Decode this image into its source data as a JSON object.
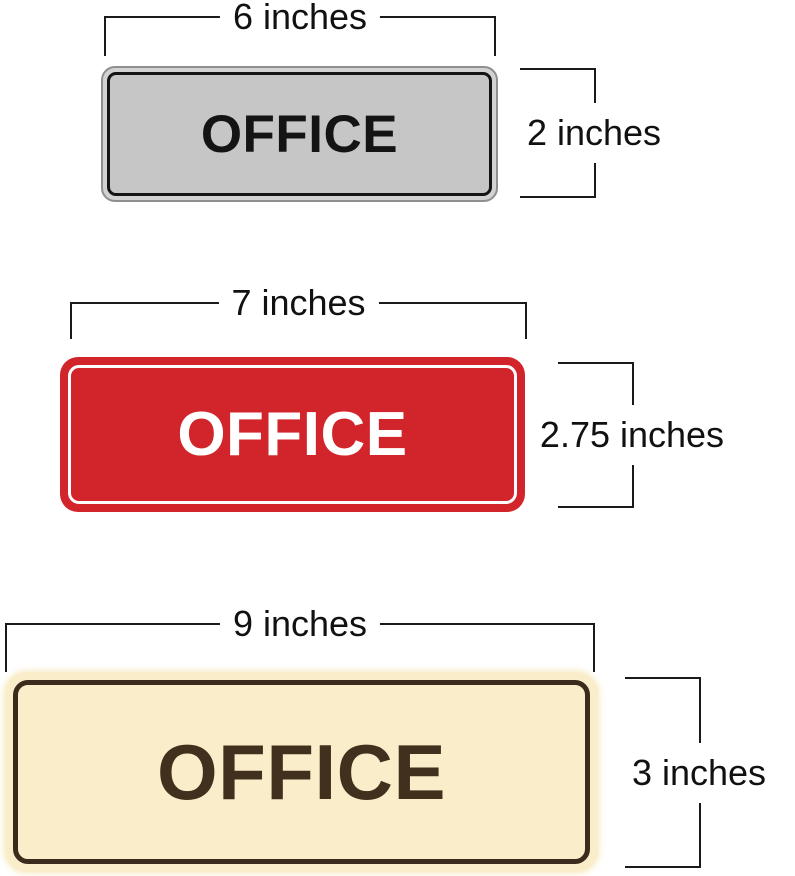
{
  "page": {
    "background": "#ffffff",
    "dimension_line_color": "#1a1a1a",
    "dimension_text_color": "#111111"
  },
  "signs": [
    {
      "name": "gray-office-sign",
      "label": "OFFICE",
      "width_label": "6 inches",
      "height_label": "2 inches",
      "colors": {
        "body": "#d2d2d2",
        "face": "#c6c6c6",
        "border": "#141414",
        "text": "#141414",
        "edge": "#8f8f8f"
      }
    },
    {
      "name": "red-office-sign",
      "label": "OFFICE",
      "width_label": "7 inches",
      "height_label": "2.75 inches",
      "colors": {
        "body": "#d2252b",
        "face": "#d2252b",
        "border": "#ffffff",
        "text": "#ffffff"
      }
    },
    {
      "name": "cream-office-sign",
      "label": "OFFICE",
      "width_label": "9 inches",
      "height_label": "3 inches",
      "colors": {
        "body": "#faeeca",
        "face": "#faeeca",
        "border": "#3a2b1c",
        "text": "#42301f"
      }
    }
  ]
}
